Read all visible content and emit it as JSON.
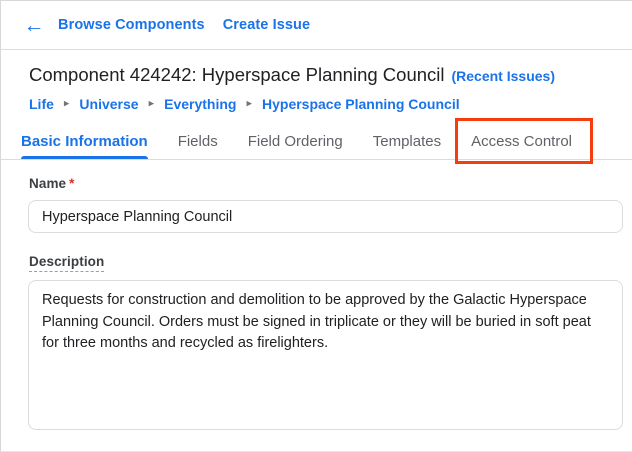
{
  "topbar": {
    "links": [
      "Browse Components",
      "Create Issue"
    ]
  },
  "icons": {
    "back": "←",
    "breadcrumb_separator": "▸"
  },
  "header": {
    "title": "Component 424242: Hyperspace Planning Council",
    "recent_issues_link": "(Recent Issues)"
  },
  "breadcrumb": {
    "items": [
      "Life",
      "Universe",
      "Everything",
      "Hyperspace Planning Council"
    ]
  },
  "tabs": {
    "items": [
      {
        "label": "Basic Information",
        "active": true
      },
      {
        "label": "Fields",
        "active": false
      },
      {
        "label": "Field Ordering",
        "active": false
      },
      {
        "label": "Templates",
        "active": false
      },
      {
        "label": "Access Control",
        "active": false,
        "annotated": true
      }
    ]
  },
  "form": {
    "name": {
      "label": "Name",
      "required_marker": "*",
      "value": "Hyperspace Planning Council"
    },
    "description": {
      "label": "Description",
      "value": "Requests for construction and demolition to be approved by the Galactic Hyperspace Planning Council. Orders must be signed in triplicate or they will be buried in soft peat for three months and recycled as firelighters."
    }
  },
  "colors": {
    "link-blue": "#1a73e8",
    "text-dark": "#202124",
    "text-gray": "#5f6368",
    "label-gray": "#3c4043",
    "border-gray": "#dadce0",
    "required-red": "#d93025",
    "annotation-red": "#f53d0e"
  }
}
